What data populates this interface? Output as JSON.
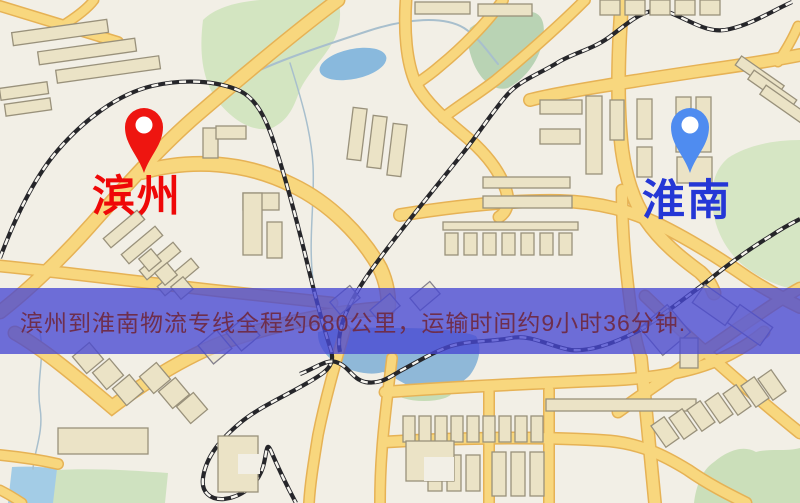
{
  "map_overlay": {
    "caption": "滨州到淮南物流专线全程约680公里，运输时间约9小时36分钟.",
    "origin": {
      "name": "滨州"
    },
    "destination": {
      "name": "淮南"
    },
    "route": {
      "distance_text": "约680公里",
      "duration_text": "约9小时36分钟",
      "service": "物流专线"
    }
  },
  "colors": {
    "caption_band": "#4848d2",
    "caption_text": "#6e2e4d",
    "origin_label": "#ef0808",
    "origin_pin": "#ee1510",
    "destination_label": "#2437d6",
    "destination_pin": "#4f8cf0",
    "road_yellow": "#f8d77e",
    "map_background": "#f2efe6",
    "park_green": "#d3e5c1",
    "water_blue": "#8fb8d8"
  },
  "icons": {
    "origin_pin": "map-pin-icon",
    "destination_pin": "map-pin-icon"
  }
}
